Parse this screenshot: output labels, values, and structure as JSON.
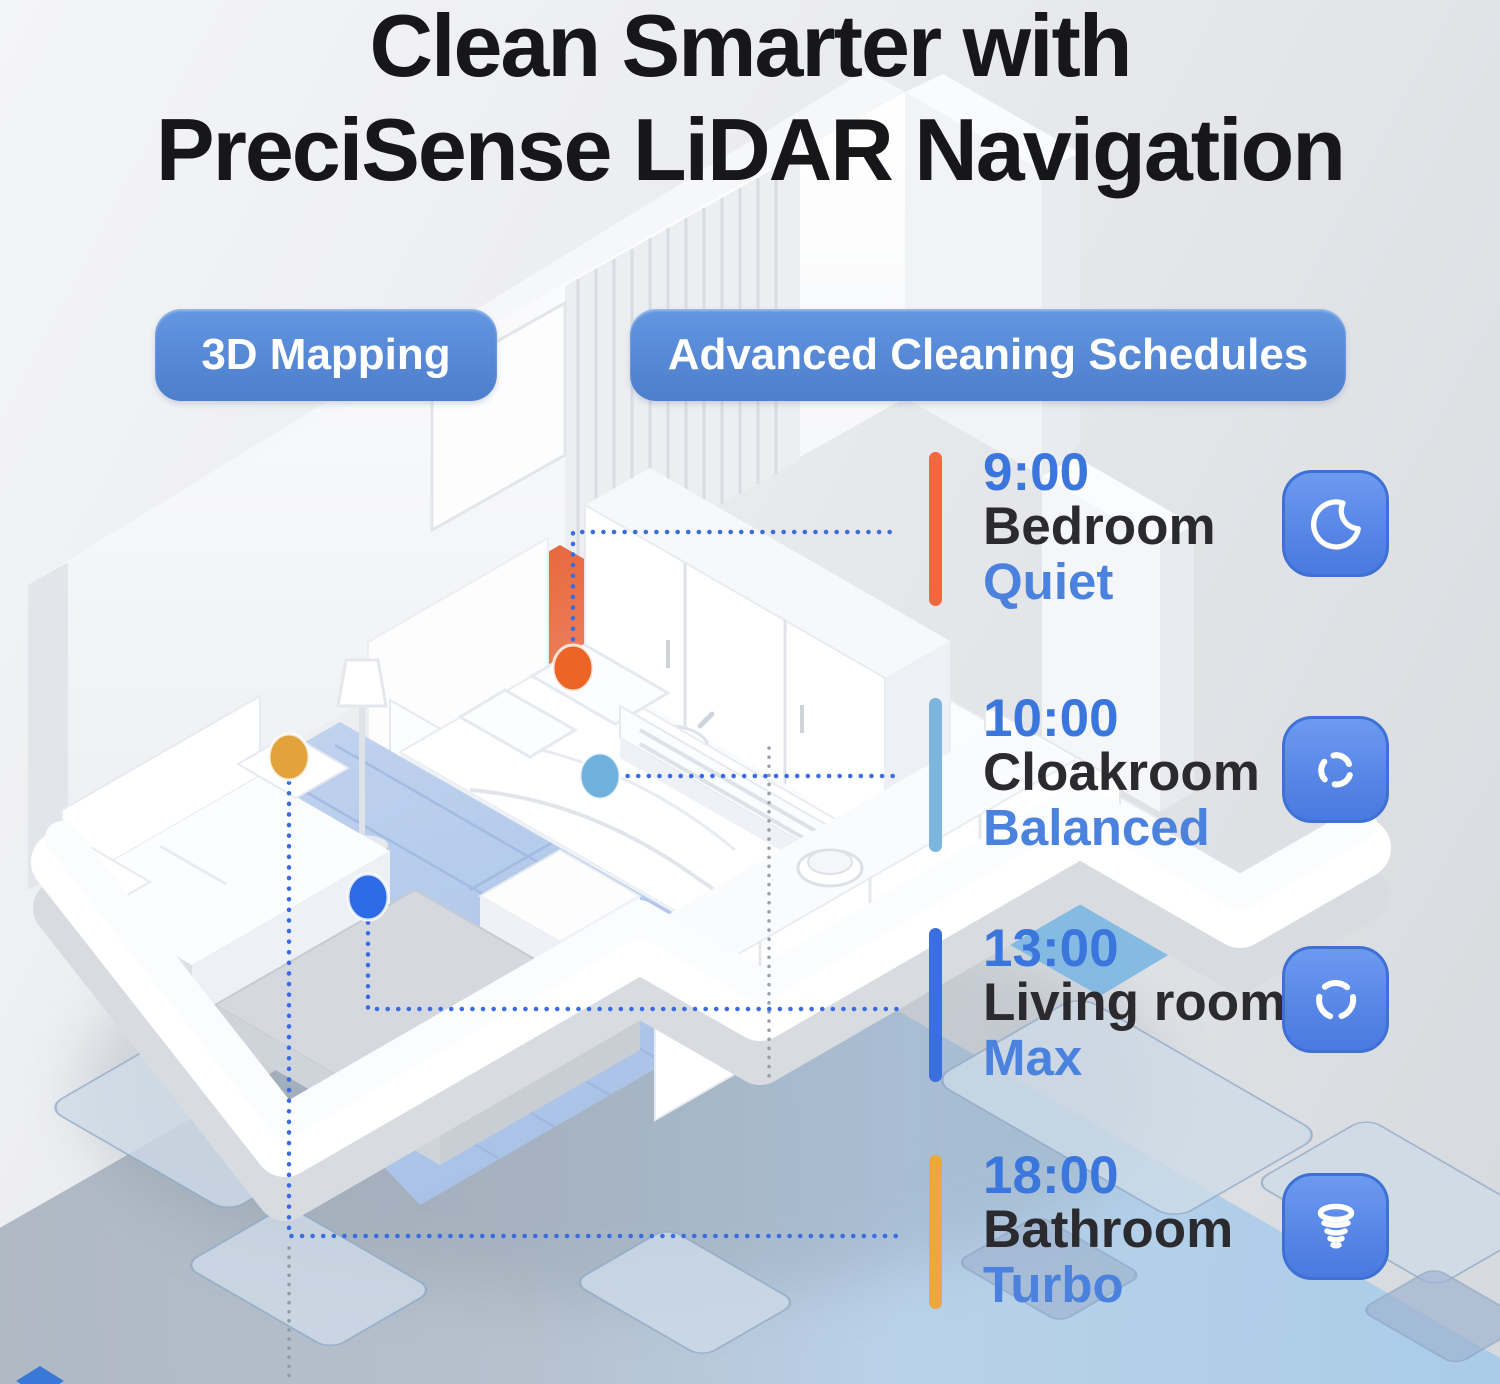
{
  "title": {
    "line1": "Clean Smarter with",
    "line2": "PreciSense LiDAR Navigation"
  },
  "badges": [
    {
      "label": "3D Mapping"
    },
    {
      "label": "Advanced Cleaning Schedules"
    }
  ],
  "schedule": {
    "entries": [
      {
        "time": "9:00",
        "room": "Bedroom",
        "mode": "Quiet",
        "bar_color": "#F0683F",
        "marker_color": "#EC6527",
        "icon": "moon-icon"
      },
      {
        "time": "10:00",
        "room": "Cloakroom",
        "mode": "Balanced",
        "bar_color": "#7CB5DD",
        "marker_color": "#6FB0DC",
        "icon": "fan-icon"
      },
      {
        "time": "13:00",
        "room": "Living room",
        "mode": "Max",
        "bar_color": "#3B6FE0",
        "marker_color": "#2D6AE3",
        "icon": "cyclone-icon"
      },
      {
        "time": "18:00",
        "room": "Bathroom",
        "mode": "Turbo",
        "bar_color": "#E9A93F",
        "marker_color": "#E2A23C",
        "icon": "tornado-icon"
      }
    ]
  },
  "colors": {
    "accent_blue": "#4E82D6",
    "text_dark": "#17171A",
    "time_blue": "#3B76DD",
    "icon_tile_blue": "#5685E6",
    "connector_blue": "#3A6CE0",
    "floor_bedroom_orange": "#E8603A",
    "floor_living_blue": "#B7CBEA",
    "floor_bathroom_yellow": "#E5A948",
    "floor_cloakroom_blue": "#7DB7E2",
    "map_sheet_blue": "#B3D2EC"
  }
}
